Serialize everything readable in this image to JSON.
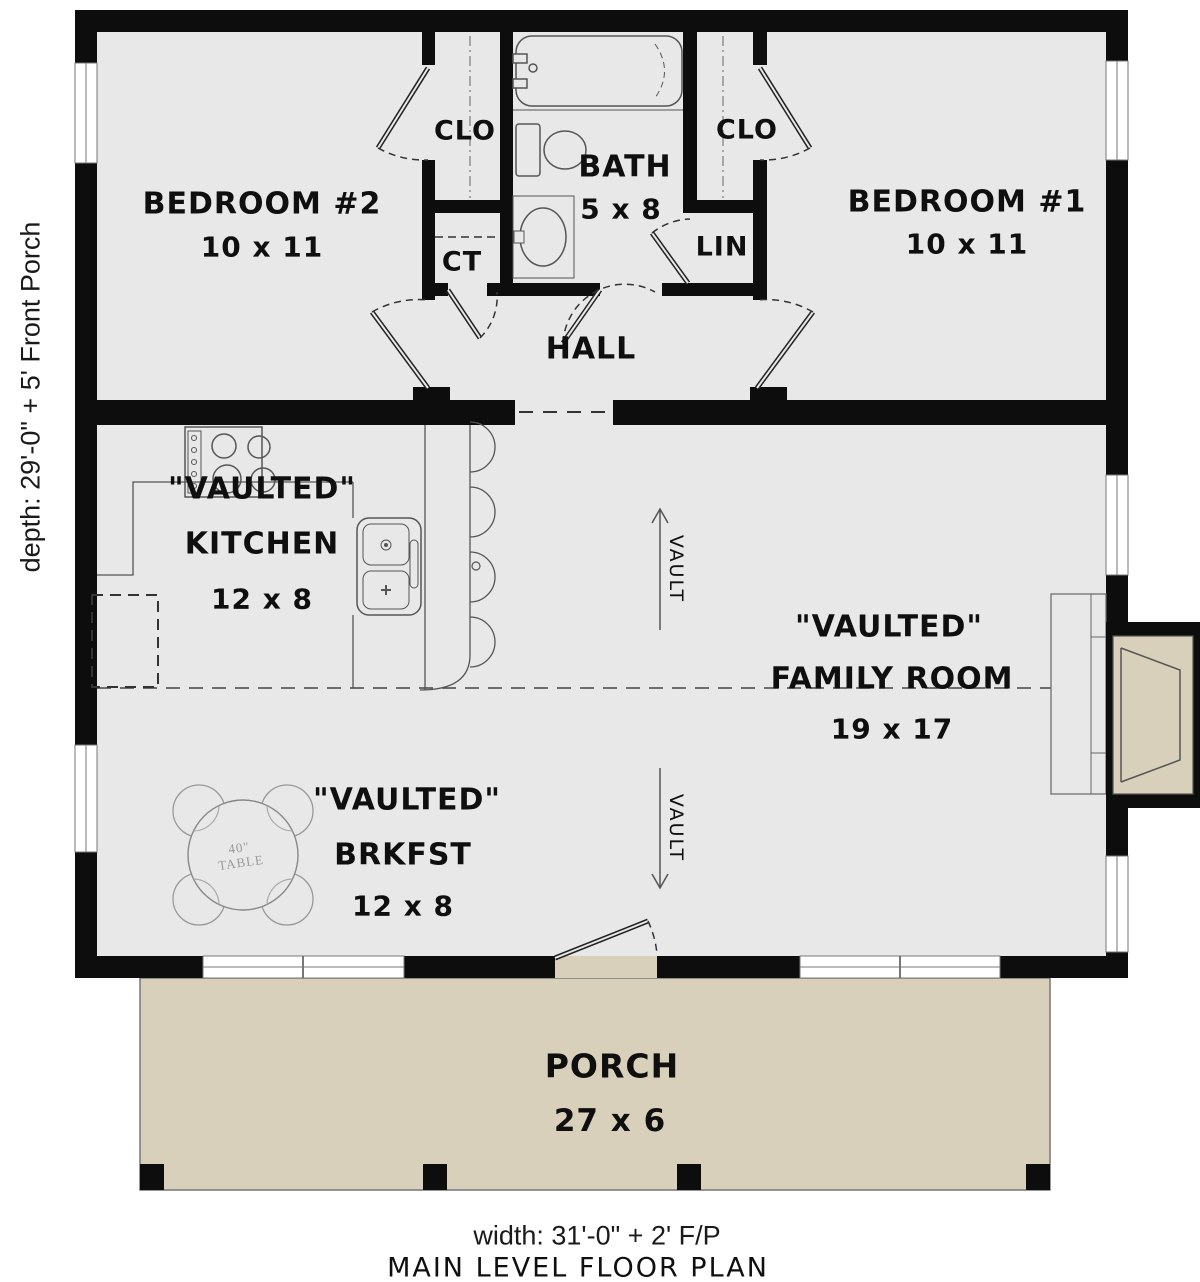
{
  "title": "MAIN LEVEL FLOOR PLAN",
  "dimensions": {
    "depth_label": "depth: 29'-0\" + 5' Front Porch",
    "width_label": "width: 31'-0\" + 2' F/P"
  },
  "rooms": {
    "bedroom2": {
      "name": "BEDROOM #2",
      "size": "10 x 11"
    },
    "bedroom1": {
      "name": "BEDROOM #1",
      "size": "10 x 11"
    },
    "bath": {
      "name": "BATH",
      "size": "5 x 8"
    },
    "hall": {
      "name": "HALL"
    },
    "kitchen": {
      "qualifier": "\"VAULTED\"",
      "name": "KITCHEN",
      "size": "12 x 8"
    },
    "family_room": {
      "qualifier": "\"VAULTED\"",
      "name": "FAMILY ROOM",
      "size": "19 x 17"
    },
    "breakfast": {
      "qualifier": "\"VAULTED\"",
      "name": "BRKFST",
      "size": "12 x 8"
    },
    "porch": {
      "name": "PORCH",
      "size": "27 x 6"
    },
    "closet_left": {
      "name": "CLO"
    },
    "closet_right": {
      "name": "CLO"
    },
    "linen": {
      "name": "LIN"
    },
    "coat": {
      "name": "CT"
    }
  },
  "annotations": {
    "vault_upper": "VAULT",
    "vault_lower": "VAULT",
    "table_line1": "40\"",
    "table_line2": "TABLE"
  },
  "colors": {
    "wall": "#0d0d0d",
    "floor": "#e8e8e8",
    "porch": "#d8d0ba",
    "drawing_line": "#555555",
    "background": "#ffffff"
  }
}
